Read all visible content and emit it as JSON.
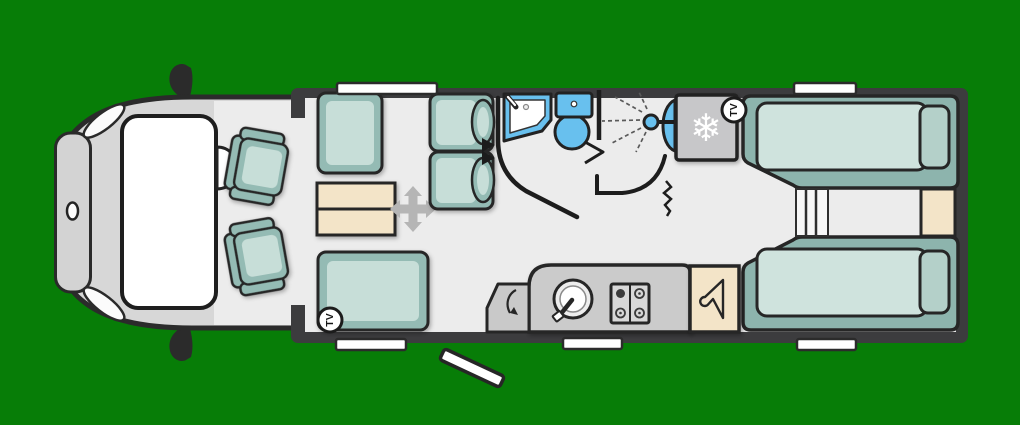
{
  "canvas": {
    "width": 1020,
    "height": 425
  },
  "labels": {
    "tv_badge": "TV"
  },
  "icons": {
    "fridge": "snowflake-icon",
    "fridge_glyph": "❄",
    "wardrobe": "hanger-icon",
    "table": "move-arrows-icon",
    "shower": "shower-spray-icon",
    "tv": "tv-badge",
    "entrance": "door-swing-arrow-icon"
  },
  "colors": {
    "background": "#077d07",
    "wall": "#3c3c3e",
    "floor": "#ececec",
    "cab_body": "#d7d7d7",
    "cab_front": "#d3d3d3",
    "upholstery": "#94bbb4",
    "upholstery_light": "#c7ded8",
    "bed_base": "#8db4ad",
    "mattress": "#cfe3dd",
    "pillow": "#b4d0c9",
    "wood": "#f3e4c8",
    "fixture_blue": "#68c0ee",
    "kitchen_unit": "#cbcbcb",
    "hob_panel": "#d8d8d8",
    "fridge": "#c7c7c9",
    "window_white": "#ffffff",
    "arrow_gray": "#b5b5b5"
  },
  "features": [
    "cab-with-two-swivel-seats",
    "front-lounge-sofas",
    "pedestal-table",
    "forward-facing-travel-seats",
    "washroom-sink",
    "toilet",
    "separate-shower",
    "fridge",
    "tv-point-front",
    "tv-point-rear",
    "kitchen-sink-and-hob",
    "entrance-door-with-step",
    "wardrobe",
    "twin-single-beds",
    "bedroom-steps",
    "bedside-cabinet",
    "windows"
  ]
}
